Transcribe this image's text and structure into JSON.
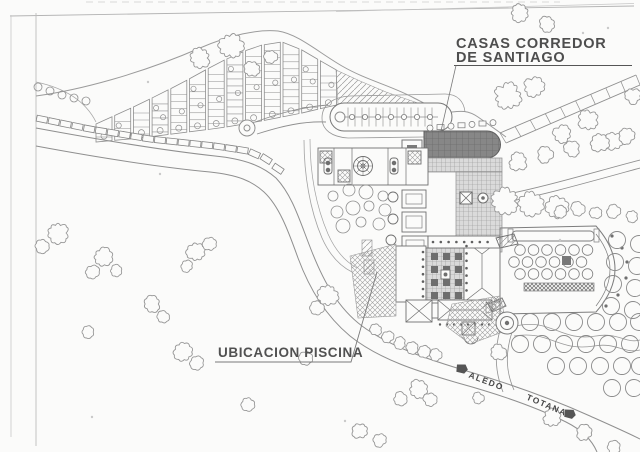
{
  "drawing": {
    "type": "scanned architectural site plan",
    "colors": {
      "paper": "#fbfbfa",
      "ink": "#8f8f8f",
      "ink_dark": "#5f5f5f",
      "label_text": "#4e4e4e",
      "dark_roof_fill": "#868686",
      "plaza_grid_fill": "#d9d9d9"
    }
  },
  "labels": {
    "title_line1": "CASAS CORREDOR",
    "title_line2": "DE SANTIAGO",
    "piscina": "UBICACION PISCINA",
    "road_aledo": "ALEDO",
    "road_totana": "TOTANA"
  },
  "icons": {
    "aledo_arrow": "road-direction-arrow-left",
    "totana_arrow": "road-direction-arrow-right"
  }
}
